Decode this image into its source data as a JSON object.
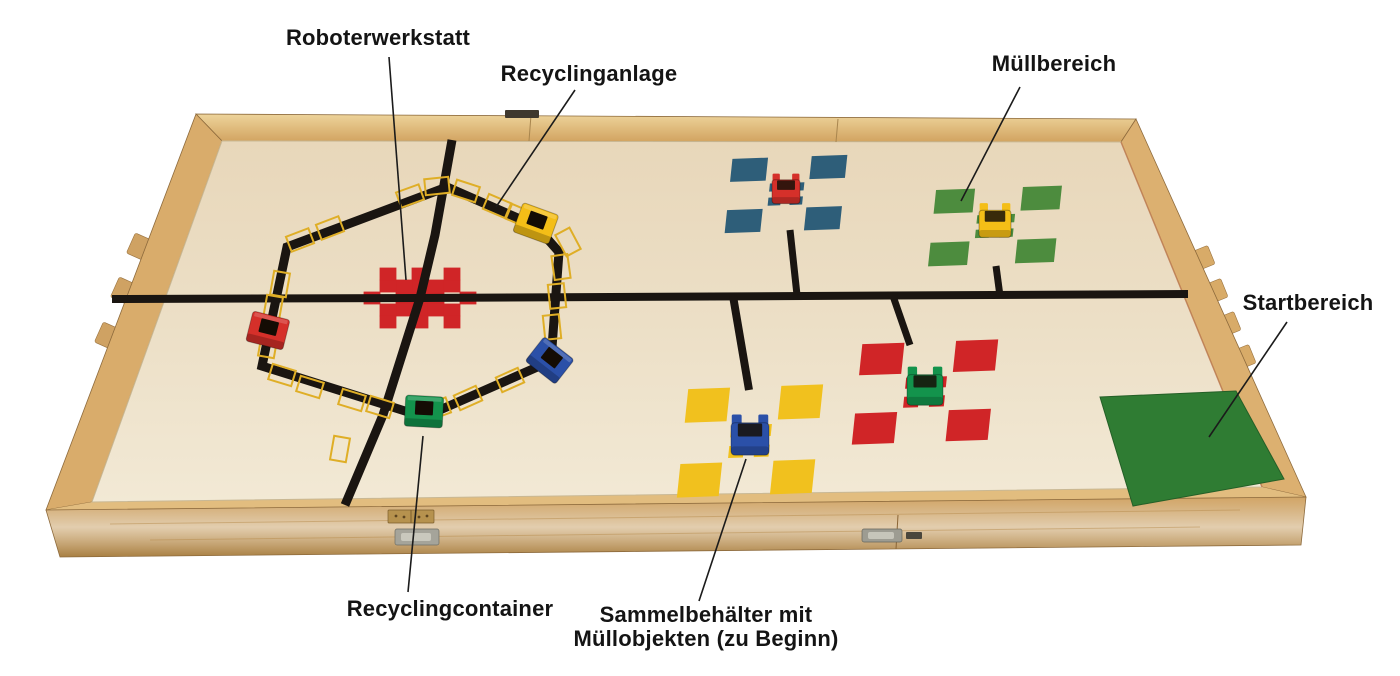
{
  "figure": {
    "kind": "annotated-photo-of-robot-arena",
    "description": "Wooden arena with black tape line course, recycling ring, waste areas and start zone"
  },
  "annotations": {
    "roboterwerkstatt": {
      "text": "Roboterwerkstatt",
      "leader": [
        389,
        57,
        406,
        280
      ]
    },
    "recyclinganlage": {
      "text": "Recyclinganlage",
      "leader": [
        575,
        90,
        496,
        207
      ]
    },
    "muellbereich": {
      "text": "Müllbereich",
      "leader": [
        1020,
        87,
        961,
        201
      ]
    },
    "startbereich": {
      "text": "Startbereich",
      "leader": [
        1287,
        322,
        1209,
        437
      ]
    },
    "recyclingcontainer": {
      "text": "Recyclingcontainer",
      "leader": [
        423,
        436,
        408,
        592
      ]
    },
    "sammelbehaelter": {
      "line1": "Sammelbehälter mit",
      "line2": "Müllobjekten (zu Beginn)",
      "leader": [
        746,
        459,
        699,
        601
      ]
    }
  },
  "board": {
    "colors": {
      "field": "#ebdec4",
      "field_light": "#f2e9d6",
      "wood": "#d9aa66",
      "wood_light": "#ecd197",
      "wood_dark": "#b98c49",
      "wood_edge": "#8d6a3c",
      "tape_black": "#1a1511",
      "tape_yellow": "#dfae26",
      "area_red": "#d02527",
      "area_blue": "#2e5e79",
      "area_green": "#4d8c3e",
      "area_yellow": "#f1c11e",
      "start_green": "#2f7c33",
      "container_red": "#d5302a",
      "container_yellow": "#f4be17",
      "container_blue": "#2b50a8",
      "container_green": "#13934c",
      "leader": "#1b1b1b",
      "label_text": "#141414"
    },
    "workshop_star": {
      "cx": 420,
      "cy": 298,
      "cell_w": 16,
      "cell_h": 12,
      "cells": [
        [
          0,
          0
        ],
        [
          1,
          0
        ],
        [
          -1,
          0
        ],
        [
          0,
          1
        ],
        [
          0,
          -1
        ],
        [
          1,
          -1
        ],
        [
          2,
          -1
        ],
        [
          2,
          -2
        ],
        [
          -1,
          -1
        ],
        [
          -2,
          -1
        ],
        [
          -2,
          -2
        ],
        [
          1,
          1
        ],
        [
          2,
          1
        ],
        [
          2,
          2
        ],
        [
          -1,
          1
        ],
        [
          -2,
          1
        ],
        [
          -2,
          2
        ],
        [
          3,
          0
        ],
        [
          -3,
          0
        ],
        [
          0,
          -2
        ],
        [
          0,
          2
        ]
      ]
    },
    "roads": [
      {
        "name": "main-line",
        "width": 8,
        "closed": false,
        "points": [
          [
            112,
            299
          ],
          [
            420,
            298
          ],
          [
            1188,
            294
          ]
        ]
      },
      {
        "name": "workshop-vertical-line",
        "width": 9,
        "closed": false,
        "points": [
          [
            452,
            140
          ],
          [
            435,
            235
          ],
          [
            420,
            298
          ],
          [
            383,
            415
          ],
          [
            345,
            505
          ]
        ]
      },
      {
        "name": "recycling-ring",
        "width": 9,
        "closed": true,
        "points": [
          [
            447,
            187
          ],
          [
            536,
            226
          ],
          [
            559,
            252
          ],
          [
            551,
            361
          ],
          [
            424,
            417
          ],
          [
            262,
            366
          ],
          [
            287,
            247
          ]
        ]
      },
      {
        "name": "branch-blue",
        "width": 7,
        "closed": false,
        "points": [
          [
            797,
            295
          ],
          [
            790,
            230
          ]
        ]
      },
      {
        "name": "branch-green",
        "width": 7,
        "closed": false,
        "points": [
          [
            1000,
            296
          ],
          [
            996,
            266
          ]
        ]
      },
      {
        "name": "branch-yellow",
        "width": 8,
        "closed": false,
        "points": [
          [
            733,
            296
          ],
          [
            749,
            390
          ]
        ]
      },
      {
        "name": "branch-red",
        "width": 7,
        "closed": false,
        "points": [
          [
            893,
            296
          ],
          [
            910,
            345
          ]
        ]
      }
    ],
    "ring_squares": [
      [
        410,
        196,
        -20
      ],
      [
        437,
        186,
        -6
      ],
      [
        466,
        191,
        18
      ],
      [
        497,
        206,
        23
      ],
      [
        520,
        216,
        23
      ],
      [
        568,
        242,
        62
      ],
      [
        561,
        267,
        82
      ],
      [
        557,
        296,
        84
      ],
      [
        552,
        327,
        84
      ],
      [
        510,
        380,
        -24
      ],
      [
        468,
        398,
        -24
      ],
      [
        437,
        409,
        -20
      ],
      [
        380,
        407,
        17
      ],
      [
        352,
        400,
        17
      ],
      [
        310,
        387,
        17
      ],
      [
        282,
        375,
        17
      ],
      [
        268,
        345,
        -80
      ],
      [
        273,
        308,
        -80
      ],
      [
        280,
        284,
        -80
      ],
      [
        300,
        240,
        -21
      ],
      [
        330,
        228,
        -21
      ],
      [
        340,
        449,
        -80
      ]
    ],
    "clusters": [
      {
        "name": "muellbereich-blue",
        "area": "area_blue",
        "cup": "container_red",
        "cx": 786,
        "cy": 194,
        "w": 115,
        "h": 74,
        "cup_size": 28
      },
      {
        "name": "muellbereich-green",
        "area": "area_green",
        "cup": "container_yellow",
        "cx": 995,
        "cy": 226,
        "w": 126,
        "h": 76,
        "cup_size": 32
      },
      {
        "name": "sammelbehaelter-yellow",
        "area": "area_yellow",
        "cup": "container_blue",
        "cx": 750,
        "cy": 441,
        "w": 135,
        "h": 108,
        "cup_size": 38
      },
      {
        "name": "muellbereich-red",
        "area": "area_red",
        "cup": "container_green",
        "cx": 925,
        "cy": 392,
        "w": 136,
        "h": 100,
        "cup_size": 36
      }
    ],
    "ring_containers": [
      {
        "name": "recyclingcontainer-red",
        "color": "container_red",
        "x": 268,
        "y": 330,
        "rot": 14
      },
      {
        "name": "recyclingcontainer-yellow",
        "color": "container_yellow",
        "x": 536,
        "y": 223,
        "rot": 20
      },
      {
        "name": "recyclingcontainer-blue",
        "color": "container_blue",
        "x": 550,
        "y": 360,
        "rot": 38
      },
      {
        "name": "recyclingcontainer-green",
        "color": "container_green",
        "x": 424,
        "y": 411,
        "rot": 3
      }
    ],
    "start_area": {
      "points": [
        [
          1100,
          397
        ],
        [
          1236,
          391
        ],
        [
          1284,
          479
        ],
        [
          1133,
          506
        ]
      ]
    }
  }
}
